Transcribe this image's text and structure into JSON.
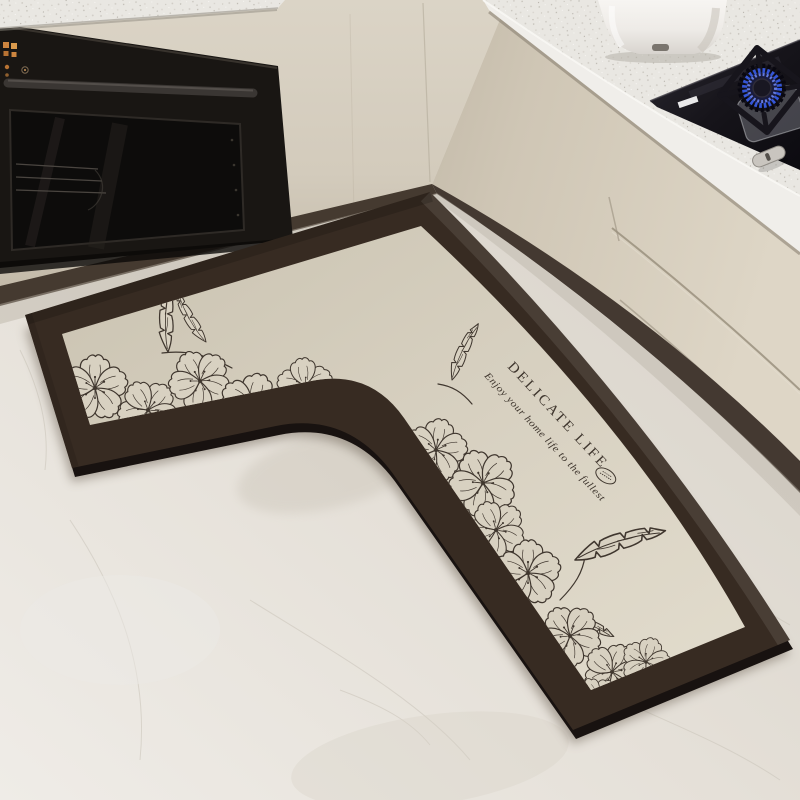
{
  "mat": {
    "title": "DELICATE LIFE",
    "subtitle": "Enjoy your home life to the fullest",
    "stamp_icon": "oval-stamp",
    "motifs": [
      "hibiscus-flower",
      "serrated-leaf"
    ],
    "colors": {
      "border": "#372b22",
      "field": "#d8d1c1",
      "line_art": "#3f362e"
    }
  },
  "kitchen": {
    "colors": {
      "cabinets": "#d4ccbc",
      "countertop": "#e9e6e1",
      "oven_black": "#191613",
      "toe_kick": "#453a30",
      "floor": "#e6e1d8",
      "gas_flame_blue": "#3556d6",
      "oven_indicator_orange": "#cd853f",
      "kettle_white": "#f3f1ee"
    }
  }
}
